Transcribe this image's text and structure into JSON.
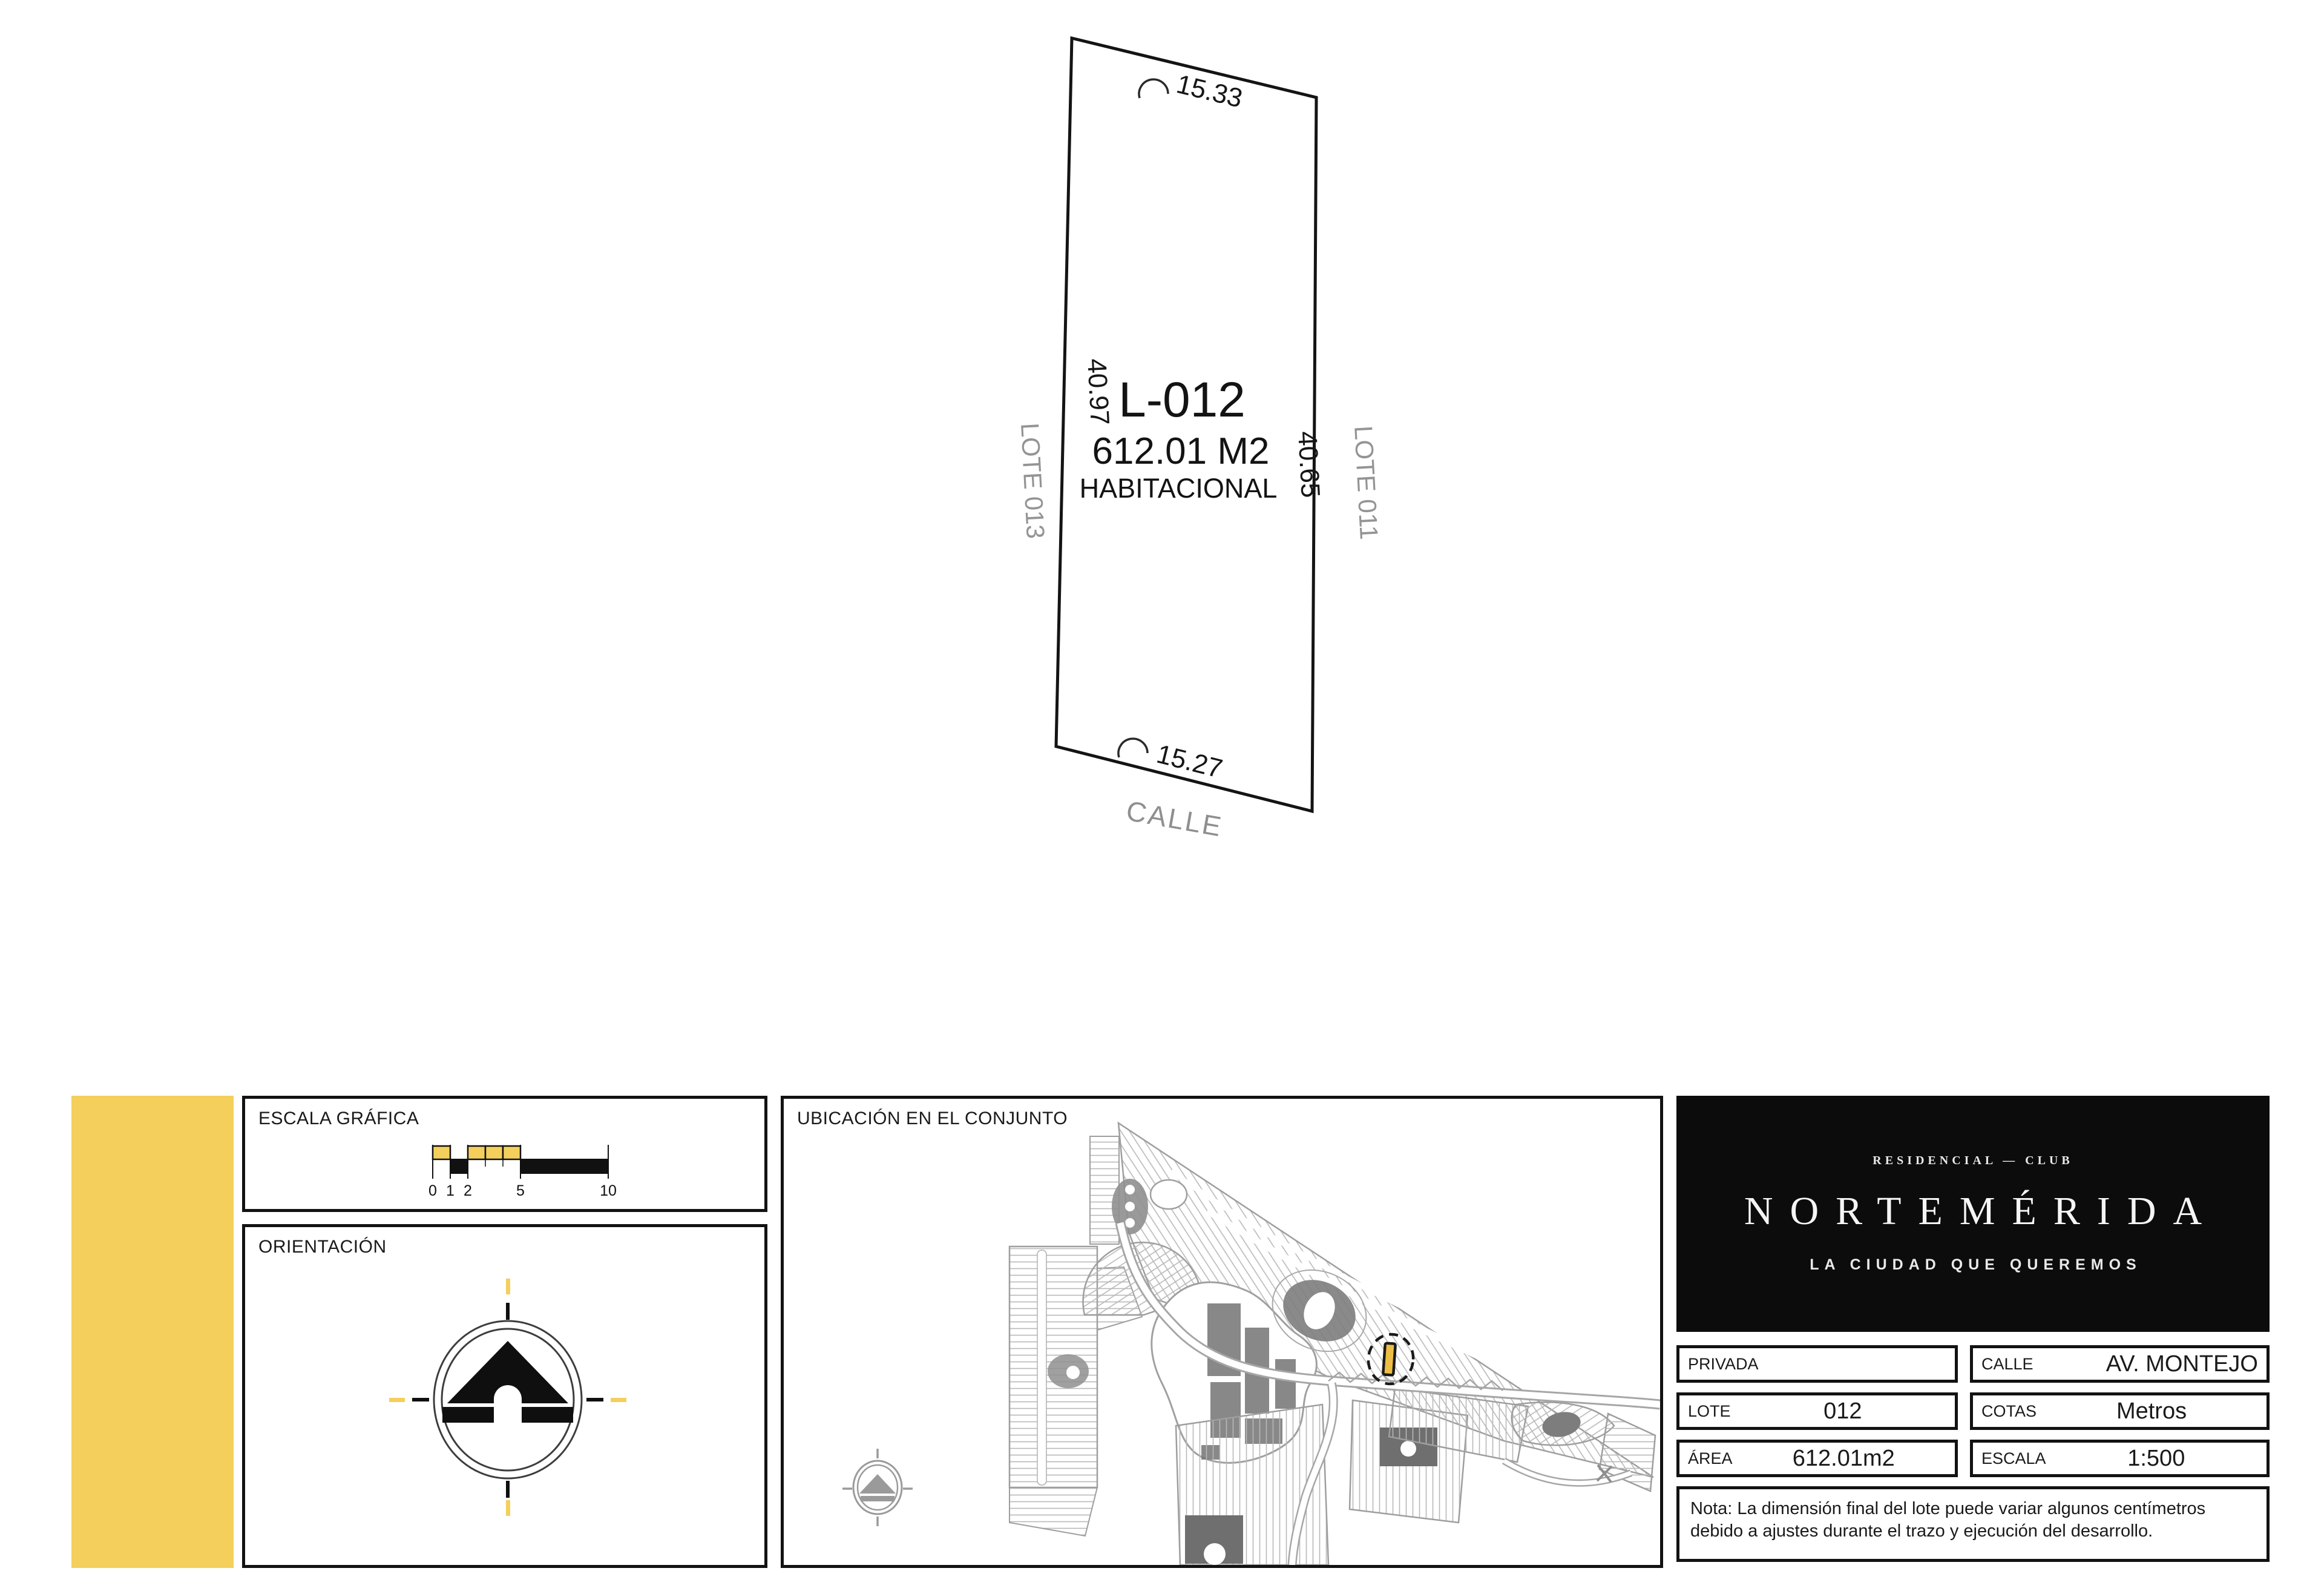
{
  "lot": {
    "id": "L-012",
    "area": "612.01 M2",
    "land_use": "HABITACIONAL",
    "dim_top": "15.33",
    "dim_bottom": "15.27",
    "dim_left": "40.97",
    "dim_right": "40.65",
    "neighbor_left": "LOTE 013",
    "neighbor_right": "LOTE 011",
    "street": "CALLE"
  },
  "panels": {
    "scale": {
      "title": "ESCALA GRÁFICA",
      "ticks": [
        "0",
        "1",
        "2",
        "5",
        "10"
      ]
    },
    "orientation": {
      "title": "ORIENTACIÓN"
    },
    "location": {
      "title": "UBICACIÓN EN EL CONJUNTO"
    }
  },
  "brand": {
    "top": "RESIDENCIAL — CLUB",
    "name": "NORTEMÉRIDA",
    "tagline": "LA CIUDAD QUE QUEREMOS"
  },
  "details": {
    "rows": [
      {
        "label": "PRIVADA",
        "value": ""
      },
      {
        "label": "LOTE",
        "value": "012"
      },
      {
        "label": "ÁREA",
        "value": "612.01m2"
      },
      {
        "label": "CALLE",
        "value": "AV. MONTEJO"
      },
      {
        "label": "COTAS",
        "value": "Metros"
      },
      {
        "label": "ESCALA",
        "value": "1:500"
      }
    ]
  },
  "note": "Nota: La dimensión final del lote puede variar algunos centímetros debido a ajustes durante el trazo y ejecución del desarrollo.",
  "colors": {
    "accent_yellow": "#F4CF5C",
    "marker_yellow": "#EDBE45",
    "gray_text": "#949494",
    "map_line": "#a9a9a9",
    "ink": "#111111"
  }
}
